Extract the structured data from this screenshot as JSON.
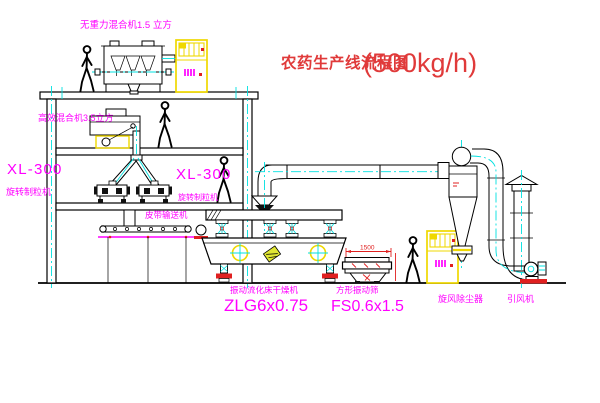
{
  "title": {
    "text_cn": "农药生产线流程图",
    "capacity": "(500kg/h)"
  },
  "equipment_labels": {
    "gravity_mixer": "无重力混合机1.5 立方",
    "high_efficiency_mixer": "高效混合机3.5立方",
    "granulator_left": {
      "model": "XL-300",
      "name": "旋转制粒机"
    },
    "granulator_center": {
      "model": "XL-300",
      "name": "旋转制粒机"
    },
    "belt_conveyor": "皮带输送机",
    "fluid_bed_dryer": {
      "name": "振动流化床干燥机",
      "model": "ZLG6x0.75"
    },
    "vibrating_sieve": {
      "name": "方形振动筛",
      "model": "FS0.6x1.5",
      "dimension": "1500"
    },
    "cyclone": "旋风除尘器",
    "induced_draft_fan": "引风机"
  },
  "colors": {
    "background": "#FFFFFF",
    "line": "#000000",
    "label_magenta": "#FF00FF",
    "title_red": "#E03A3A",
    "centerline_cyan": "#00E0E0",
    "highlight_yellow": "#EFD800",
    "accent_red": "#E02020"
  }
}
